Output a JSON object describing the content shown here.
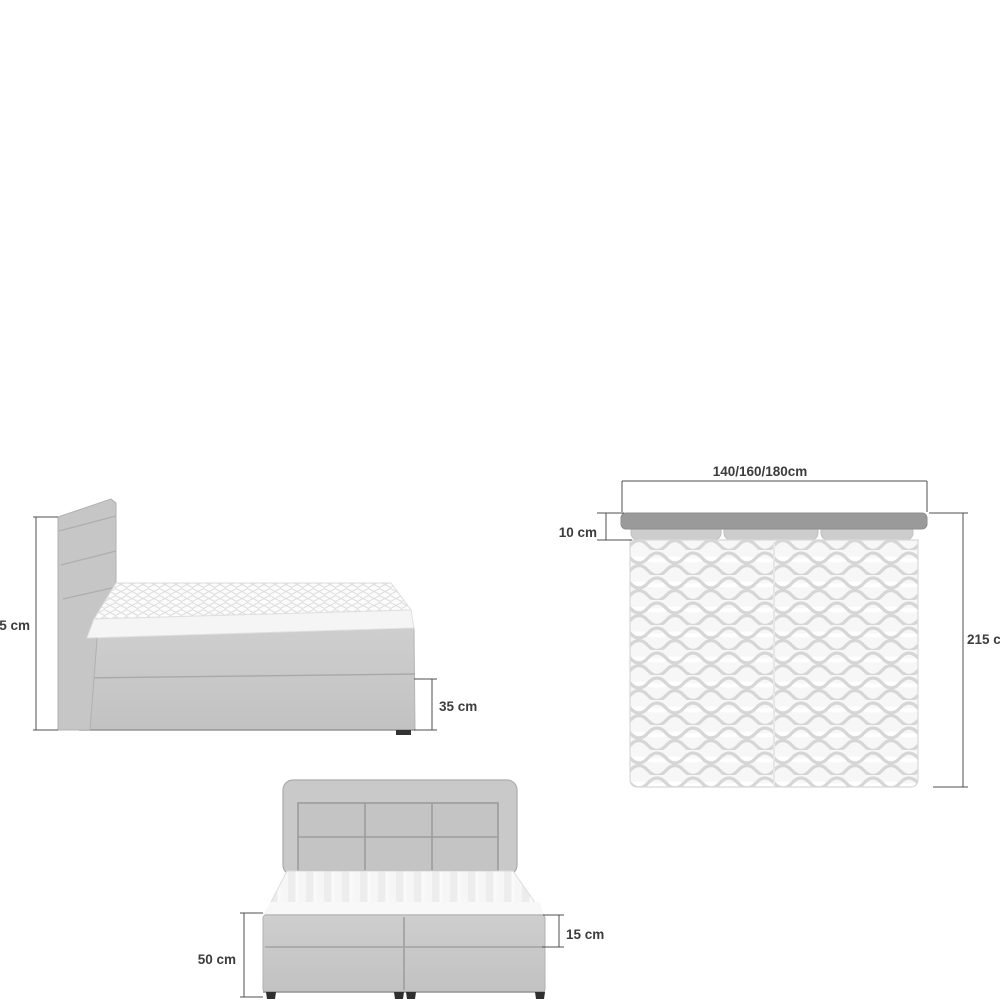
{
  "diagram": {
    "subject": "boxspring-bed-dimensions",
    "side_view": {
      "height_label": "115 cm",
      "foot_box_label": "35 cm"
    },
    "top_view": {
      "width_label": "140/160/180cm",
      "headboard_depth_label": "10 cm",
      "length_label": "215 cm"
    },
    "front_view": {
      "base_height_label": "50 cm",
      "box_top_label": "15 cm"
    },
    "colors": {
      "background": "#ffffff",
      "fabric": "#c8c8c8",
      "fabric_panel": "#c4c4c4",
      "headboard_strip": "#9a9a9a",
      "pillow": "#cdcdcd",
      "mattress": "#f6f6f6",
      "pattern_line": "#d6d6d6",
      "seam_line": "#a3a3a3",
      "dimension_line": "#4f4f4f",
      "label_text": "#3c3c3c",
      "feet": "#333333"
    }
  }
}
